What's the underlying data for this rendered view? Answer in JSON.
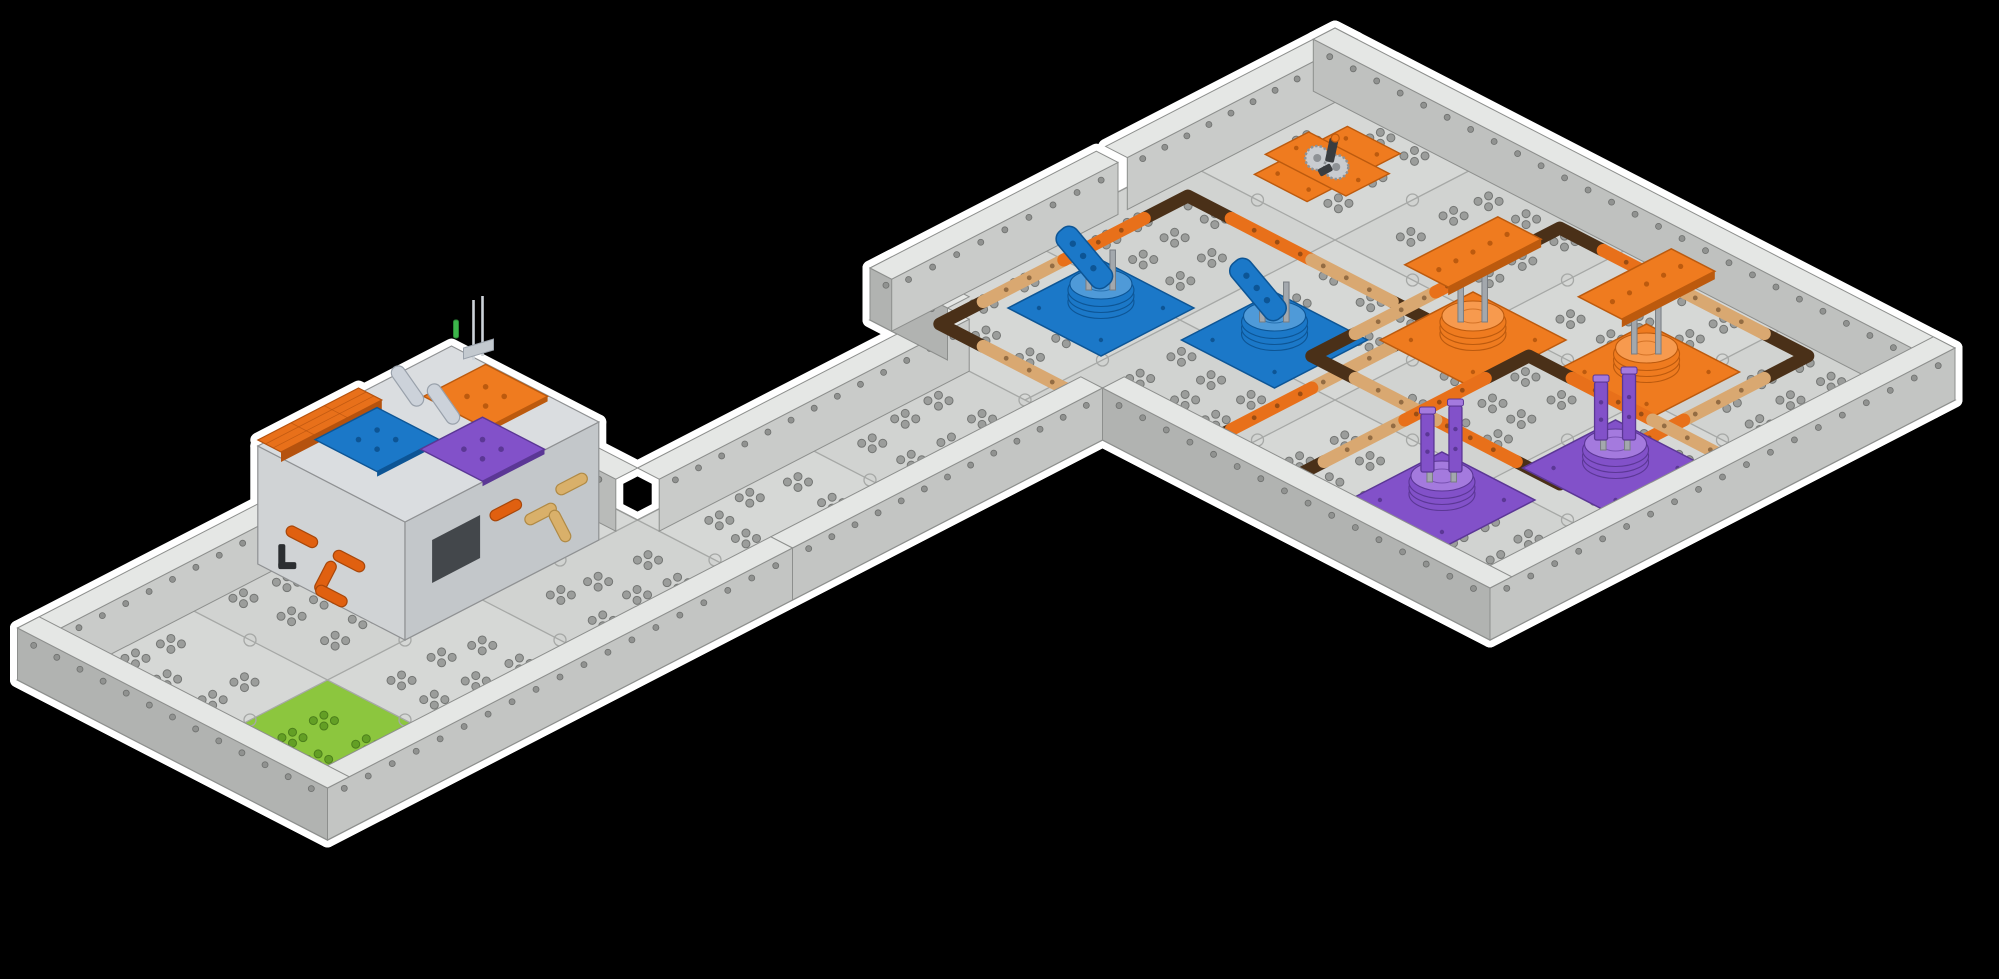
{
  "canvas": {
    "width": 1999,
    "height": 979,
    "background": "#000000",
    "glow": "#ffffff",
    "glow_width": 15
  },
  "field": {
    "projection": {
      "ox": 250,
      "oy": 800,
      "ux": 155,
      "vy": 80
    },
    "boundary": [
      [
        0,
        -1.5
      ],
      [
        3,
        -1.5
      ],
      [
        3,
        -0.5
      ],
      [
        5,
        -0.5
      ],
      [
        5,
        -1
      ],
      [
        8,
        -1
      ],
      [
        8,
        3
      ],
      [
        5,
        3
      ],
      [
        5,
        0.5
      ],
      [
        3,
        0.5
      ],
      [
        0,
        0.5
      ]
    ],
    "tiles": [
      [
        0,
        -1.5
      ],
      [
        1,
        -1.5
      ],
      [
        2,
        -1.5
      ],
      [
        0,
        -0.5
      ],
      [
        1,
        -0.5
      ],
      [
        2,
        -0.5
      ],
      [
        3,
        -0.5
      ],
      [
        4,
        -0.5
      ],
      [
        5,
        -1
      ],
      [
        6,
        -1
      ],
      [
        7,
        -1
      ],
      [
        5,
        0
      ],
      [
        6,
        0
      ],
      [
        7,
        0
      ],
      [
        5,
        1
      ],
      [
        6,
        1
      ],
      [
        7,
        1
      ],
      [
        5,
        2
      ],
      [
        6,
        2
      ],
      [
        7,
        2
      ]
    ],
    "green_tile": {
      "x": 0,
      "y": -0.5,
      "fill": "#8cc63e",
      "dot_fill": "#639f25",
      "dot_stroke": "#4c7f1b"
    },
    "tile_fill_a": "#d6d8d6",
    "tile_fill_b": "#d1d3d1",
    "seam": "#a6a8a6",
    "edge": "#979997",
    "dot_fill": "#9b9d9b",
    "dot_stroke": "#747674",
    "seams_v": [
      [
        1,
        -1.5,
        0.5
      ],
      [
        2,
        -1.5,
        0.5
      ],
      [
        3,
        -0.5,
        0.5
      ],
      [
        4,
        -0.5,
        0.5
      ],
      [
        5,
        -0.5,
        0.5
      ],
      [
        6,
        -1,
        3
      ],
      [
        7,
        -1,
        3
      ]
    ],
    "seams_h": [
      [
        -0.5,
        0,
        3
      ],
      [
        0,
        5,
        8
      ],
      [
        1,
        5,
        8
      ],
      [
        2,
        5,
        8
      ]
    ],
    "wall": {
      "height": 52,
      "thickness": 0.14,
      "top": "#e5e7e5",
      "stroke": "#8d8f8d",
      "hole_fill": "#909290",
      "hole_stroke": "#6e706e"
    },
    "walls": [
      {
        "a": [
          0,
          -1.5
        ],
        "b": [
          1.72,
          -1.5
        ],
        "in": [
          0,
          0.14
        ],
        "face": "in",
        "order": "back",
        "color": "#c9cbc9"
      },
      {
        "a": [
          1.78,
          -1.5
        ],
        "b": [
          3,
          -1.5
        ],
        "in": [
          0,
          0.14
        ],
        "face": "in",
        "order": "back",
        "color": "#c9cbc9"
      },
      {
        "a": [
          3,
          -1.5
        ],
        "b": [
          3,
          -0.5
        ],
        "in": [
          -0.14,
          0
        ],
        "face": "in",
        "order": "back",
        "color": "#b9bbb9"
      },
      {
        "a": [
          3,
          -0.5
        ],
        "b": [
          5,
          -0.5
        ],
        "in": [
          0,
          0.14
        ],
        "face": "in",
        "order": "back",
        "color": "#c9cbc9"
      },
      {
        "a": [
          5,
          -1
        ],
        "b": [
          5,
          -0.5
        ],
        "in": [
          0.14,
          0
        ],
        "face": "out",
        "order": "back",
        "color": "#b1b3b1"
      },
      {
        "a": [
          5,
          -1
        ],
        "b": [
          6.46,
          -1
        ],
        "in": [
          0,
          0.14
        ],
        "face": "in",
        "order": "back",
        "color": "#c9cbc9"
      },
      {
        "a": [
          6.52,
          -1
        ],
        "b": [
          8,
          -1
        ],
        "in": [
          0,
          0.14
        ],
        "face": "in",
        "order": "back",
        "color": "#c9cbc9"
      },
      {
        "a": [
          8,
          -1
        ],
        "b": [
          8,
          3
        ],
        "in": [
          -0.14,
          0
        ],
        "face": "in",
        "order": "back",
        "color": "#bfc1bf"
      },
      {
        "a": [
          5,
          3
        ],
        "b": [
          8,
          3
        ],
        "in": [
          0,
          -0.14
        ],
        "face": "out",
        "order": "front",
        "color": "#c3c5c3"
      },
      {
        "a": [
          5,
          0.5
        ],
        "b": [
          5,
          3
        ],
        "in": [
          0.14,
          0
        ],
        "face": "out",
        "order": "front",
        "color": "#b1b3b1"
      },
      {
        "a": [
          3,
          0.5
        ],
        "b": [
          5,
          0.5
        ],
        "in": [
          0,
          -0.14
        ],
        "face": "out",
        "order": "front",
        "color": "#c3c5c3"
      },
      {
        "a": [
          0,
          0.5
        ],
        "b": [
          3,
          0.5
        ],
        "in": [
          0,
          -0.14
        ],
        "face": "out",
        "order": "front",
        "color": "#c3c5c3"
      },
      {
        "a": [
          0,
          -1.5
        ],
        "b": [
          0,
          0.5
        ],
        "in": [
          0.14,
          0
        ],
        "face": "out",
        "order": "front",
        "color": "#b1b3b1"
      }
    ]
  },
  "zone_border": {
    "width": 13,
    "corner_color": "#4a3018",
    "side_colors": [
      [
        "#d9a871",
        "#e8701a"
      ],
      [
        "#e8701a",
        "#d9a871"
      ],
      [
        "#d9a871",
        "#e8701a"
      ],
      [
        "#e8701a",
        "#d9a871"
      ]
    ],
    "hole": "rgba(62,35,12,0.45)"
  },
  "mech_params": {
    "lever": {
      "post_h": 34
    },
    "platform": {
      "post_h": 62,
      "paddle_lift": 88
    },
    "tower": {
      "post_h": 40
    }
  },
  "zones": [
    {
      "name": "blue-lever-zone",
      "center": [
        6.0,
        0.05
      ],
      "half": 0.8,
      "corner": 0.28,
      "type": "lever",
      "count": 2,
      "offsets": [
        [
          -0.18,
          -0.38
        ],
        [
          0.18,
          0.38
        ]
      ],
      "colors": {
        "main": "#1b78c8",
        "dark": "#0d5595",
        "light": "#4f9ad8"
      }
    },
    {
      "name": "orange-platform-zone",
      "center": [
        7.0,
        1.45
      ],
      "half": 0.8,
      "corner": 0.28,
      "type": "platform",
      "count": 2,
      "offsets": [
        [
          -0.18,
          -0.38
        ],
        [
          0.18,
          0.38
        ]
      ],
      "colors": {
        "main": "#ef7b1f",
        "dark": "#bc5a0e",
        "light": "#f79a4e"
      }
    },
    {
      "name": "purple-tower-zone",
      "center": [
        6.1,
        2.15
      ],
      "half": 0.8,
      "corner": 0.28,
      "type": "tower",
      "count": 2,
      "offsets": [
        [
          -0.38,
          -0.18
        ],
        [
          0.38,
          0.18
        ]
      ],
      "colors": {
        "main": "#8251c9",
        "dark": "#5b3795",
        "light": "#a47ade"
      }
    }
  ],
  "gear_assembly": {
    "name": "orange-gear-assembly",
    "pos": [
      7.45,
      -0.5
    ],
    "plate": "#ef7b1f",
    "plate_dark": "#bc5a0e",
    "gear": "#c9ccd0",
    "gear_dark": "#8e9296",
    "metal": "#3a3d40"
  },
  "structure": {
    "name": "platform-structure",
    "footprint": [
      1.5,
      -1.45,
      2.75,
      -0.5
    ],
    "height": 118,
    "face_sw": "#d0d3d5",
    "face_se": "#c3c7ca",
    "top": "#dadde0",
    "stroke": "#8f9193",
    "roof": {
      "rect": [
        1.5,
        -1.45,
        2.15,
        -1.3
      ],
      "lift": 124,
      "fill": "#e8701a",
      "dark": "#b5520e"
    },
    "plates": [
      {
        "name": "blue-plate",
        "cx": 1.9,
        "cy": -1.08,
        "fill": "#1b78c8",
        "dark": "#0d5595"
      },
      {
        "name": "orange-plate",
        "cx": 2.52,
        "cy": -1.0,
        "fill": "#ef7b1f",
        "dark": "#bc5a0e"
      },
      {
        "name": "purple-plate",
        "cx": 2.18,
        "cy": -0.68,
        "fill": "#8251c9",
        "dark": "#5b3795"
      }
    ],
    "trim": "#e06010",
    "trim_dark": "#a8470a",
    "slide": "#ccd2da",
    "slide_dark": "#99a1ab",
    "tan": "#d9b06a",
    "tan_dark": "#b08a45",
    "pin": "#3cb54a",
    "pin_dark": "#2a8736",
    "dark_metal": "#2b2e31",
    "panel": "#43474b",
    "antenna": "#cdd3d9",
    "bracket": "#c3c9cf"
  },
  "beam_row": {
    "name": "beam-row",
    "from": [
      1.85,
      0.08
    ],
    "to": [
      3.15,
      0.08
    ],
    "splits": [
      0,
      0.36,
      0.64,
      1
    ],
    "colors": [
      "#1b78c8",
      "#ef7b1f",
      "#1b78c8"
    ],
    "hole": "rgba(255,255,255,0.5)"
  }
}
